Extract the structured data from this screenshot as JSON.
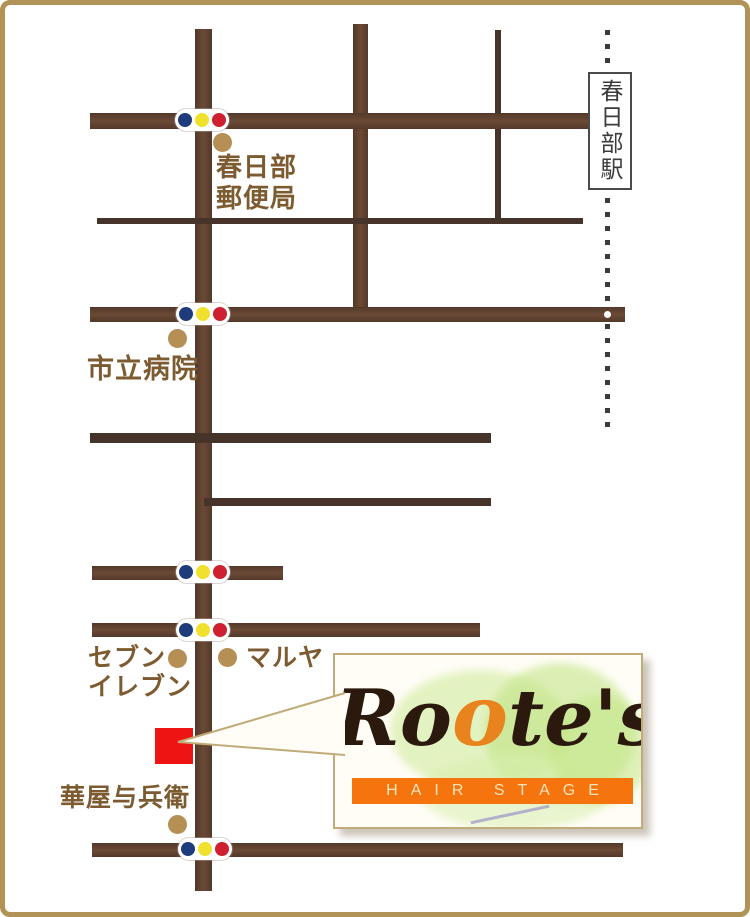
{
  "map": {
    "labels": {
      "post_office": "春日部\n郵便局",
      "hospital": "市立病院",
      "seven_eleven": "セブン\nイレブン",
      "maruya": "マルヤ",
      "hanaya_yohei": "華屋与兵衛",
      "station": "春日部駅"
    },
    "traffic_light_count": 5,
    "colors": {
      "frame": "#b19257",
      "road_brown": "#5a3c2b",
      "road_thin": "#46332a",
      "label_text": "#7d5b30",
      "poi_dot": "#b68f55",
      "salon_marker_red": "#ee1414",
      "railway_dot": "#3b3b3b",
      "traffic_blue": "#1e3c7c",
      "traffic_yellow": "#f0e12f",
      "traffic_red": "#ce2030"
    }
  },
  "callout": {
    "brand_part1": "Ro",
    "brand_part2": "o",
    "brand_part3": "te's",
    "subtitle": "HAIR STAGE",
    "colors": {
      "brand_text": "#2b190e",
      "brand_orange_o": "#e8831d",
      "band_orange": "#f5740e",
      "band_text": "#ffe3bc",
      "panel_border": "#c0ab79"
    }
  }
}
